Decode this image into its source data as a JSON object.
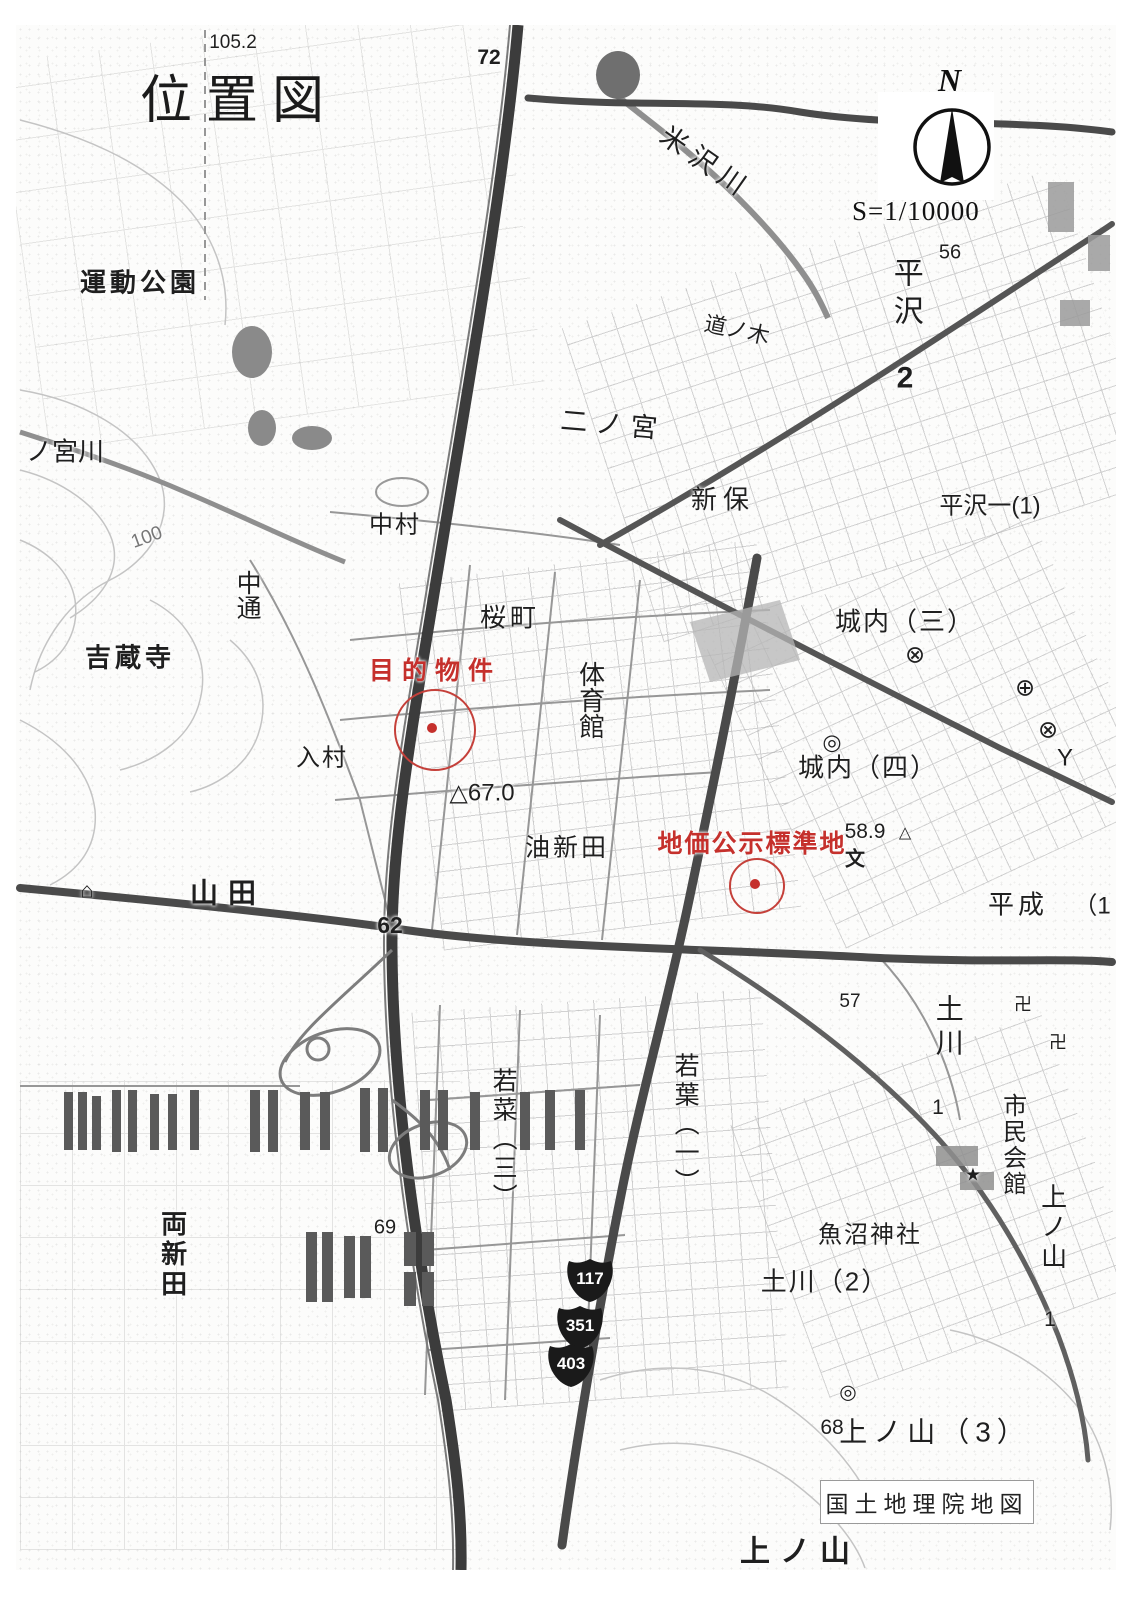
{
  "header": {
    "title": "位置図"
  },
  "compass": {
    "north_label": "N",
    "scale_label": "S=1/10000"
  },
  "credit": {
    "label": "国土地理院地図"
  },
  "annotations": {
    "color": "#c5302c",
    "target_property": {
      "label": "目的物件"
    },
    "standard_land": {
      "label": "地価公示標準地"
    }
  },
  "route_shields": [
    {
      "number": "117",
      "x": 590,
      "y": 1280
    },
    {
      "number": "351",
      "x": 580,
      "y": 1327
    },
    {
      "number": "403",
      "x": 571,
      "y": 1365
    }
  ],
  "map": {
    "labels": [
      {
        "t": "105.2",
        "x": 233,
        "y": 43,
        "s": 19
      },
      {
        "t": "72",
        "x": 489,
        "y": 58,
        "s": 21,
        "b": 1
      },
      {
        "t": "運動公園",
        "x": 140,
        "y": 283,
        "s": 26,
        "b": 1,
        "ls": 4
      },
      {
        "t": "米沢川",
        "x": 706,
        "y": 163,
        "s": 27,
        "r": 35,
        "ls": 8,
        "n": "river-label"
      },
      {
        "t": "道ノ木",
        "x": 737,
        "y": 330,
        "s": 22,
        "r": 12
      },
      {
        "t": "平沢",
        "x": 905,
        "y": 295,
        "s": 30,
        "v": 1,
        "ls": 8
      },
      {
        "t": "2",
        "x": 905,
        "y": 378,
        "s": 30,
        "b": 1
      },
      {
        "t": "56",
        "x": 950,
        "y": 253,
        "s": 20
      },
      {
        "t": "二ノ宮",
        "x": 613,
        "y": 425,
        "s": 27,
        "r": 5,
        "ls": 8
      },
      {
        "t": "新保",
        "x": 723,
        "y": 500,
        "s": 26,
        "ls": 6
      },
      {
        "t": "平沢一(1)",
        "x": 990,
        "y": 506,
        "s": 24
      },
      {
        "t": "中村",
        "x": 395,
        "y": 525,
        "s": 24,
        "ls": 2
      },
      {
        "t": "中通",
        "x": 247,
        "y": 595,
        "s": 25,
        "v": 1
      },
      {
        "t": "ノ宮川",
        "x": 65,
        "y": 452,
        "s": 26,
        "n": "river-label"
      },
      {
        "t": "100",
        "x": 147,
        "y": 538,
        "s": 19,
        "r": -20,
        "c": "#777"
      },
      {
        "t": "桜町",
        "x": 510,
        "y": 618,
        "s": 26,
        "ls": 4
      },
      {
        "t": "体育館",
        "x": 590,
        "y": 700,
        "s": 26,
        "v": 1
      },
      {
        "t": "吉蔵寺",
        "x": 130,
        "y": 658,
        "s": 26,
        "b": 1,
        "ls": 4
      },
      {
        "t": "城内（三）",
        "x": 905,
        "y": 622,
        "s": 26,
        "ls": 2
      },
      {
        "t": "城内（四）",
        "x": 868,
        "y": 768,
        "s": 26,
        "ls": 2
      },
      {
        "t": "入村",
        "x": 322,
        "y": 758,
        "s": 24,
        "ls": 2
      },
      {
        "t": "△67.0",
        "x": 482,
        "y": 793,
        "s": 24
      },
      {
        "t": "油新田",
        "x": 567,
        "y": 848,
        "s": 25,
        "ls": 3
      },
      {
        "t": "58.9",
        "x": 865,
        "y": 832,
        "s": 21
      },
      {
        "t": "△",
        "x": 905,
        "y": 834,
        "s": 16,
        "n": "survey-point-symbol"
      },
      {
        "t": "文",
        "x": 855,
        "y": 860,
        "s": 20,
        "b": 1,
        "n": "school-symbol"
      },
      {
        "t": "山田",
        "x": 228,
        "y": 893,
        "s": 28,
        "b": 1,
        "ls": 10
      },
      {
        "t": "62",
        "x": 390,
        "y": 925,
        "s": 23,
        "b": 1
      },
      {
        "t": "平成",
        "x": 1018,
        "y": 905,
        "s": 26,
        "ls": 4
      },
      {
        "t": "（1",
        "x": 1092,
        "y": 906,
        "s": 24
      },
      {
        "t": "57",
        "x": 850,
        "y": 1002,
        "s": 19
      },
      {
        "t": "土川",
        "x": 948,
        "y": 1028,
        "s": 28,
        "v": 1,
        "ls": 6
      },
      {
        "t": "1",
        "x": 938,
        "y": 1108,
        "s": 21
      },
      {
        "t": "若菜（三）",
        "x": 503,
        "y": 1140,
        "s": 25,
        "v": 1,
        "ls": 4
      },
      {
        "t": "若葉（一）",
        "x": 685,
        "y": 1125,
        "s": 25,
        "v": 1,
        "ls": 4
      },
      {
        "t": "市民会館",
        "x": 1012,
        "y": 1145,
        "s": 24,
        "v": 1,
        "ls": 2
      },
      {
        "t": "上ノ山",
        "x": 1052,
        "y": 1228,
        "s": 26,
        "v": 1,
        "ls": 4
      },
      {
        "t": "1",
        "x": 1050,
        "y": 1320,
        "s": 21
      },
      {
        "t": "両新田",
        "x": 172,
        "y": 1255,
        "s": 26,
        "v": 1,
        "b": 1,
        "ls": 4
      },
      {
        "t": "69",
        "x": 385,
        "y": 1228,
        "s": 20
      },
      {
        "t": "魚沼神社",
        "x": 870,
        "y": 1235,
        "s": 24,
        "ls": 2
      },
      {
        "t": "土川（2）",
        "x": 825,
        "y": 1282,
        "s": 26,
        "ls": 2
      },
      {
        "t": "68",
        "x": 832,
        "y": 1428,
        "s": 21
      },
      {
        "t": "上ノ山（3）",
        "x": 935,
        "y": 1432,
        "s": 28,
        "ls": 6
      },
      {
        "t": "上ノ山",
        "x": 800,
        "y": 1552,
        "s": 30,
        "b": 1,
        "ls": 10
      },
      {
        "t": "⊗",
        "x": 915,
        "y": 655,
        "s": 24,
        "n": "police-box-symbol"
      },
      {
        "t": "⊗",
        "x": 1048,
        "y": 730,
        "s": 24,
        "n": "police-box-symbol"
      },
      {
        "t": "⊕",
        "x": 1025,
        "y": 688,
        "s": 24,
        "n": "crossed-circle-symbol"
      },
      {
        "t": "Y",
        "x": 1065,
        "y": 758,
        "s": 24,
        "n": "fire-station-symbol"
      },
      {
        "t": "◎",
        "x": 832,
        "y": 742,
        "s": 22,
        "n": "government-office-symbol"
      },
      {
        "t": "卍",
        "x": 1023,
        "y": 1005,
        "s": 18,
        "n": "temple-symbol"
      },
      {
        "t": "卍",
        "x": 1058,
        "y": 1043,
        "s": 18,
        "n": "temple-symbol"
      },
      {
        "t": "★",
        "x": 973,
        "y": 1175,
        "s": 18,
        "n": "star-symbol"
      },
      {
        "t": "◎",
        "x": 848,
        "y": 1393,
        "s": 20,
        "n": "town-office-symbol"
      },
      {
        "t": "⌂",
        "x": 87,
        "y": 890,
        "s": 22,
        "n": "monument-symbol"
      }
    ]
  }
}
